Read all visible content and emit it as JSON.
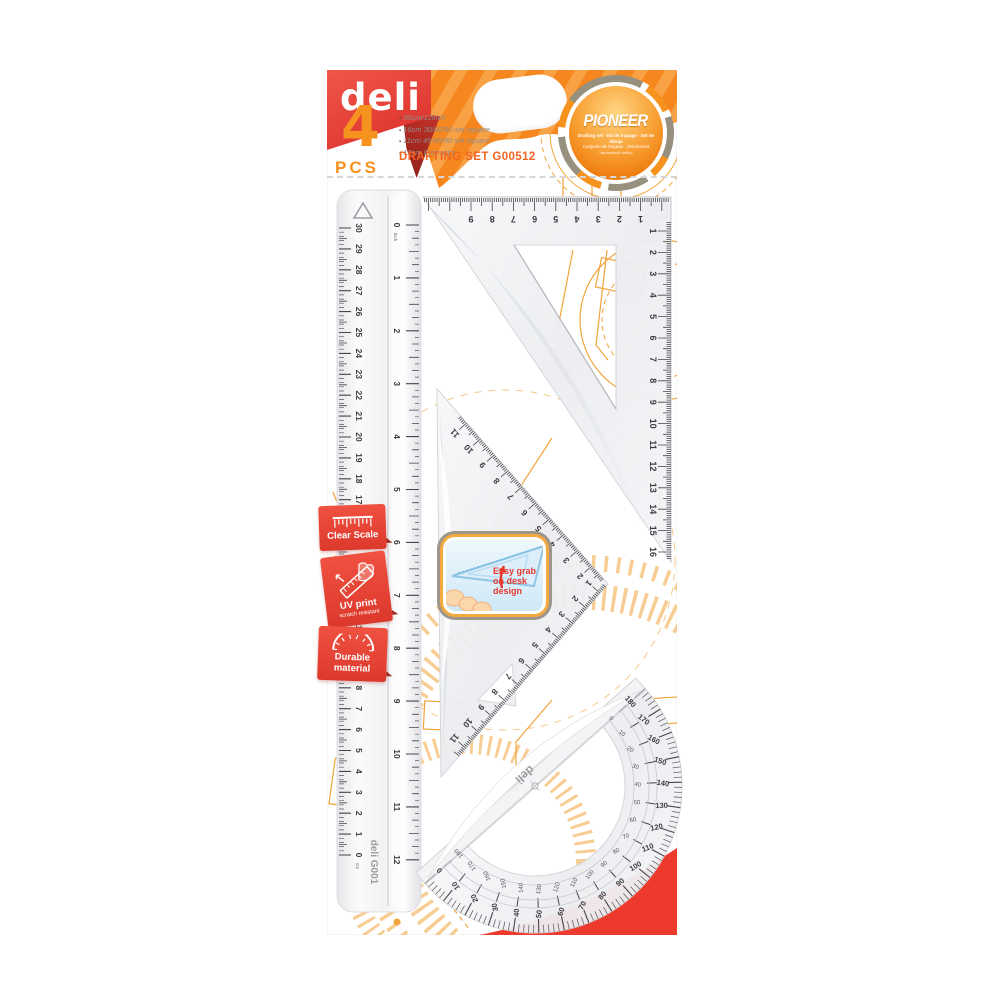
{
  "product": {
    "brand": "deli",
    "series": "PIONEER",
    "count": "4",
    "count_unit": "PCS",
    "title": "DRAFTING SET G00512",
    "specs": [
      "30cm/12inch",
      "16cm 30/60/90 set square",
      "11cm 45/45/90 set square",
      "12cm Protractor"
    ],
    "badge_sub1": "Drafting set · Kit de traçage · Set de dibujo",
    "badge_sub2": "Conjunto de traçado · Zeichenset",
    "badge_sub3": "Чертежный набор"
  },
  "features": [
    {
      "title": "Clear Scale",
      "icon": "ruler-scale-icon"
    },
    {
      "title": "UV print",
      "subtitle": "scratch resistant",
      "icon": "hand-ruler-icon"
    },
    {
      "title": "Durable material",
      "icon": "arc-scale-icon"
    }
  ],
  "callout": {
    "text": "Easy grab on desk design",
    "icon": "hand-grab-triangle-illustration"
  },
  "tools": {
    "ruler": {
      "name": "30cm ruler",
      "brand": "deli",
      "model": "G001",
      "cm_unit": "cm",
      "inch_unit": "inch",
      "cm_labels": [
        0,
        1,
        2,
        3,
        4,
        5,
        6,
        7,
        8,
        9,
        10,
        11,
        12,
        13,
        14,
        15,
        16,
        17,
        18,
        19,
        20,
        21,
        22,
        23,
        24,
        25,
        26,
        27,
        28,
        29,
        30
      ],
      "inch_labels": [
        0,
        1,
        2,
        3,
        4,
        5,
        6,
        7,
        8,
        9,
        10,
        11,
        12
      ]
    },
    "triangle_30_60_90": {
      "name": "16cm 30/60/90 set square",
      "top_scale": [
        9,
        8,
        7,
        6,
        5,
        4,
        3,
        2,
        1
      ],
      "side_scale": [
        1,
        2,
        3,
        4,
        5,
        6,
        7,
        8,
        9,
        10,
        11,
        12,
        13,
        14,
        15,
        16
      ]
    },
    "triangle_45": {
      "name": "11cm 45/45/90 set square",
      "hyp_scale": [
        11,
        10,
        9,
        8,
        7,
        6,
        5,
        4,
        3,
        2
      ],
      "leg_scale": [
        1,
        2,
        3,
        4,
        5,
        6,
        7,
        8,
        9,
        10,
        11
      ]
    },
    "protractor": {
      "name": "12cm protractor",
      "brand": "deli",
      "outer_scale": [
        0,
        10,
        20,
        30,
        40,
        50,
        60,
        70,
        80,
        90,
        100,
        110,
        120,
        130,
        140,
        150,
        160,
        170,
        180
      ],
      "inner_scale": [
        180,
        170,
        160,
        150,
        140,
        130,
        120,
        110,
        100,
        90,
        80,
        70,
        60,
        50,
        40,
        30,
        20,
        10,
        0
      ]
    }
  },
  "colors": {
    "brand_red": "#e8423b",
    "orange": "#f6871f",
    "accent_orange": "#f26522",
    "badge_red": "#e94a3a",
    "line_orange": "#f2a43c",
    "swoosh_red": "#ee3a2c"
  }
}
